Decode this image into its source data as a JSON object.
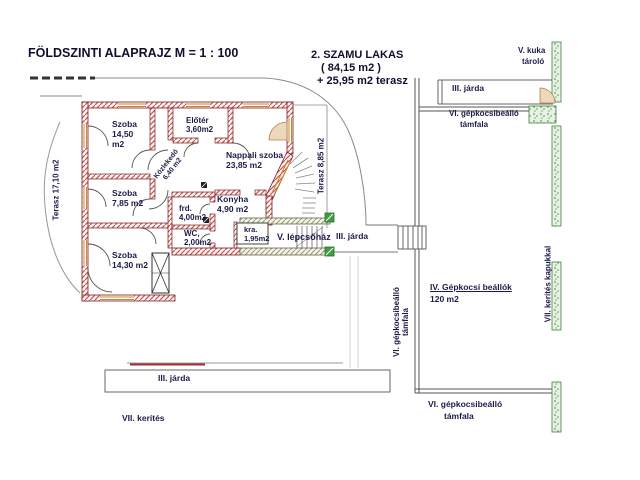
{
  "title": "FÖLDSZINTI  ALAPRAJZ   M = 1 : 100",
  "apartment": {
    "line1": "2. SZAMU  LAKAS",
    "line2": "( 84,15  m2 )",
    "line3": "+ 25,95  m2 terasz"
  },
  "rooms": {
    "szoba1": {
      "name": "Szoba",
      "area": "14,50",
      "unit": "m2"
    },
    "eloter": {
      "name": "Előtér",
      "area": "3,60m2"
    },
    "kozlekedo": {
      "name": "Közlekedő",
      "area": "6,40 m2"
    },
    "nappali": {
      "name": "Nappali szoba",
      "area": "23,85 m2"
    },
    "szoba2": {
      "name": "Szoba",
      "area": "7,85 m2"
    },
    "furdo": {
      "name": "frd.",
      "area": "4,00m2"
    },
    "konyha": {
      "name": "Konyha",
      "area": "4,90 m2"
    },
    "wc": {
      "name": "WC,",
      "area": "2,00m2"
    },
    "kamra": {
      "name": "kra.",
      "area": "1,95m2"
    },
    "szoba3": {
      "name": "Szoba",
      "area": "14,30  m2"
    },
    "lepcsohaz": {
      "name": "V. lépcsőház"
    }
  },
  "terraces": {
    "left": "Terasz 17,10 m2",
    "right": "Terasz 8,85 m2"
  },
  "site": {
    "kuka_line1": "V. kuka",
    "kuka_line2": "tároló",
    "jarda_top": "III. járda",
    "jarda_mid": "III. járda",
    "jarda_bottom": "III. járda",
    "gepkocsi_top_line1": "VI. gépkocsibeálló",
    "gepkocsi_top_line2": "támfala",
    "gepkocsi_left_line1": "VI. gépkocsibeálló",
    "gepkocsi_left_line2": "támfala",
    "gepkocsi_bottom_line1": "VI. gépkocsibeálló",
    "gepkocsi_bottom_line2": "támfala",
    "parking_line1": "IV. Gépkocsi beállók",
    "parking_line2": "120 m2",
    "kerites_bottom": "VII. kerítés",
    "kerites_right": "VII. kerítés kapukkal"
  },
  "colors": {
    "wall_hatch": "#c25656",
    "wall_border": "#7a1f1f",
    "window_frame": "#c8862e",
    "fence_green": "#4d9e4d",
    "stair_hatch": "#9a9a72",
    "site_line": "#888888",
    "label_text": "#1c1c48",
    "meter_green": "#3f9f3f"
  }
}
